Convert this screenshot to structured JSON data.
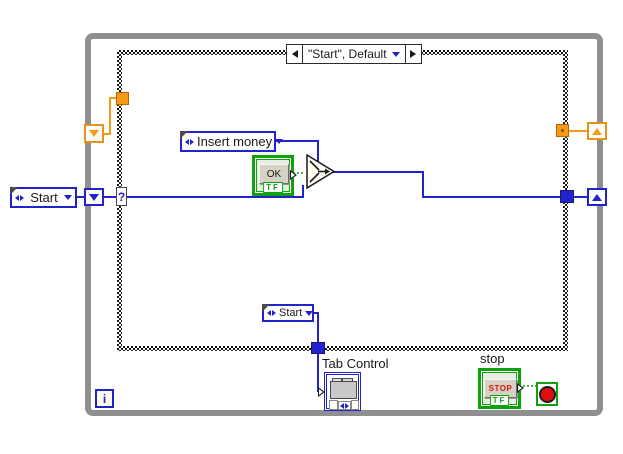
{
  "diagram": {
    "case_selector": {
      "label": "\"Start\", Default"
    },
    "selector_terminal": "?",
    "constants": {
      "start_left": "Start",
      "insert_money": "Insert money",
      "start_bottom": "Start"
    },
    "terminals": {
      "ok": {
        "button_label": "OK",
        "datatype_label": "TF"
      },
      "stop": {
        "caption": "stop",
        "button_label": "STOP",
        "datatype_label": "TF"
      },
      "tab_control": {
        "caption": "Tab Control"
      },
      "iteration": {
        "label": "i"
      }
    },
    "colors": {
      "wire_blue": "#2323cd",
      "wire_orange": "#f79a18",
      "boolean_green": "#0ca30c",
      "loop_border_gray": "#8f8f8f",
      "stop_red": "#e01010",
      "button_face": "#d5d1c5"
    }
  }
}
